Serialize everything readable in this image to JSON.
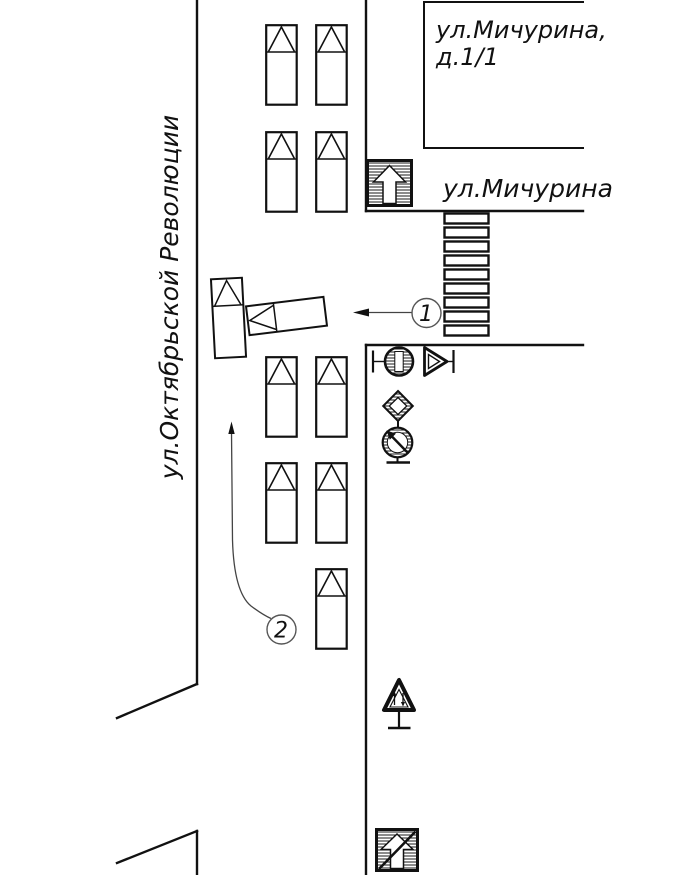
{
  "page": {
    "background": "#ffffff",
    "line_color": "#000000",
    "leader_color": "#444444"
  },
  "labels": {
    "street_vertical": "ул.Октябрьской Революции",
    "street_horizontal": "ул.Мичурина",
    "building_line1": "ул.Мичурина,",
    "building_line2": "д.1/1",
    "marker1": "1",
    "marker2": "2"
  },
  "signs": [
    {
      "icon": "one-way-road-sign"
    },
    {
      "icon": "no-entry-sign"
    },
    {
      "icon": "give-way-sign"
    },
    {
      "icon": "main-road-sign"
    },
    {
      "icon": "no-parking-arrow-sign"
    },
    {
      "icon": "two-way-traffic-sign"
    },
    {
      "icon": "end-of-one-way-road-sign"
    }
  ],
  "vehicles": {
    "parked_cars": 9,
    "collision_vehicles": 2
  },
  "crosswalk": {
    "stripes": 9
  }
}
